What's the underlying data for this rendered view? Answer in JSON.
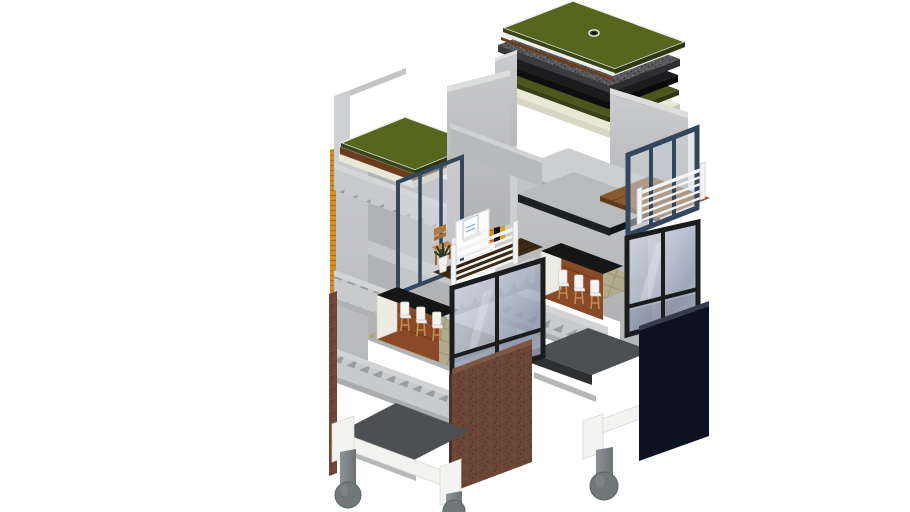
{
  "meta": {
    "description": "Exploded axonometric 3D model of two stacked modular micro-housing units with layered green roof assemblies, glazed facades, balconies and pilotis legs on a white background"
  },
  "colors": {
    "background": "#ffffff",
    "green_roof": "#57661f",
    "green_roof_edge": "#39451a",
    "roof_brown": "#6a3c1c",
    "roof_black": "#141414",
    "roof_cream": "#e9e7d6",
    "roof_speckle": "#58585a",
    "concrete_light": "#c9cacc",
    "concrete_mid": "#b5b6b8",
    "rib_triangle": "#9b9da0",
    "window_blue_frame": "#32465c",
    "window_black_frame": "#1b1c1e",
    "glass_blue": "#aeb6c8",
    "railing_white": "#f3f4f4",
    "wood_floor": "#8a5a2e",
    "balcony_wood": "#3d2a16",
    "counter_black": "#161616",
    "counter_wood": "#8a4a28",
    "cabinet_white": "#edece2",
    "tile_floor": "#b2aa8d",
    "brick_brown": "#6b4536",
    "brick_orange": "#d28c2c",
    "accent_yellow": "#d7a41f",
    "facade_navy": "#0d1220",
    "slab_dark": "#4c5052",
    "leg_gray": "#72777a",
    "frame_white": "#f3f3f1",
    "plant_green": "#2e3a1c",
    "chair_wood": "#b07a42"
  },
  "scene": {
    "modules": [
      {
        "id": "left-module",
        "parts": [
          "green-roof",
          "roof-build-up-edge",
          "ribbed-slab-edges",
          "blue-glazing",
          "balcony-railing",
          "desk-with-laptop",
          "wood-chair",
          "potted-plant",
          "kitchen-bar",
          "bar-stools",
          "black-window",
          "brick-panel",
          "floor-plate",
          "pilotis-legs"
        ]
      },
      {
        "id": "right-module",
        "parts": [
          "exploded-green-roof-assembly",
          "roof-drain",
          "roof-membrane-layers",
          "insulation-layer",
          "ribbed-slab-edges",
          "floor-plates",
          "wood-floor-plate",
          "blue-window",
          "balcony-railing",
          "kitchen-bar",
          "bar-stools",
          "black-window",
          "dark-facade-panel",
          "floor-plate",
          "pilotis-leg"
        ]
      }
    ]
  }
}
